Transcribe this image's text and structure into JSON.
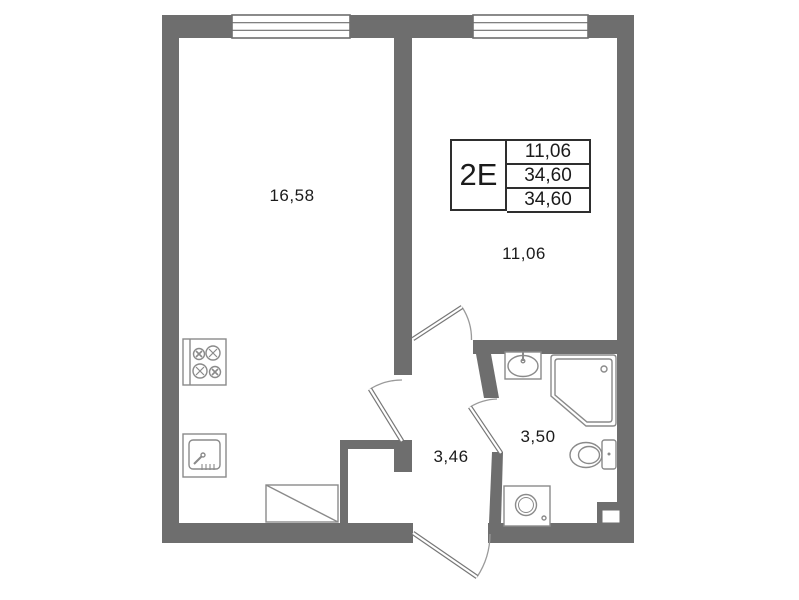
{
  "unit": {
    "type_label": "2Е",
    "table": {
      "row1": "11,06",
      "row2": "34,60",
      "row3": "34,60"
    }
  },
  "rooms": {
    "living": {
      "area": "16,58"
    },
    "bedroom": {
      "area": "11,06"
    },
    "hall": {
      "area": "3,46"
    },
    "bathroom": {
      "area": "3,50"
    }
  },
  "colors": {
    "wall": "#6e6e6e",
    "fixture_line": "#8a8a8a",
    "text": "#111111"
  }
}
